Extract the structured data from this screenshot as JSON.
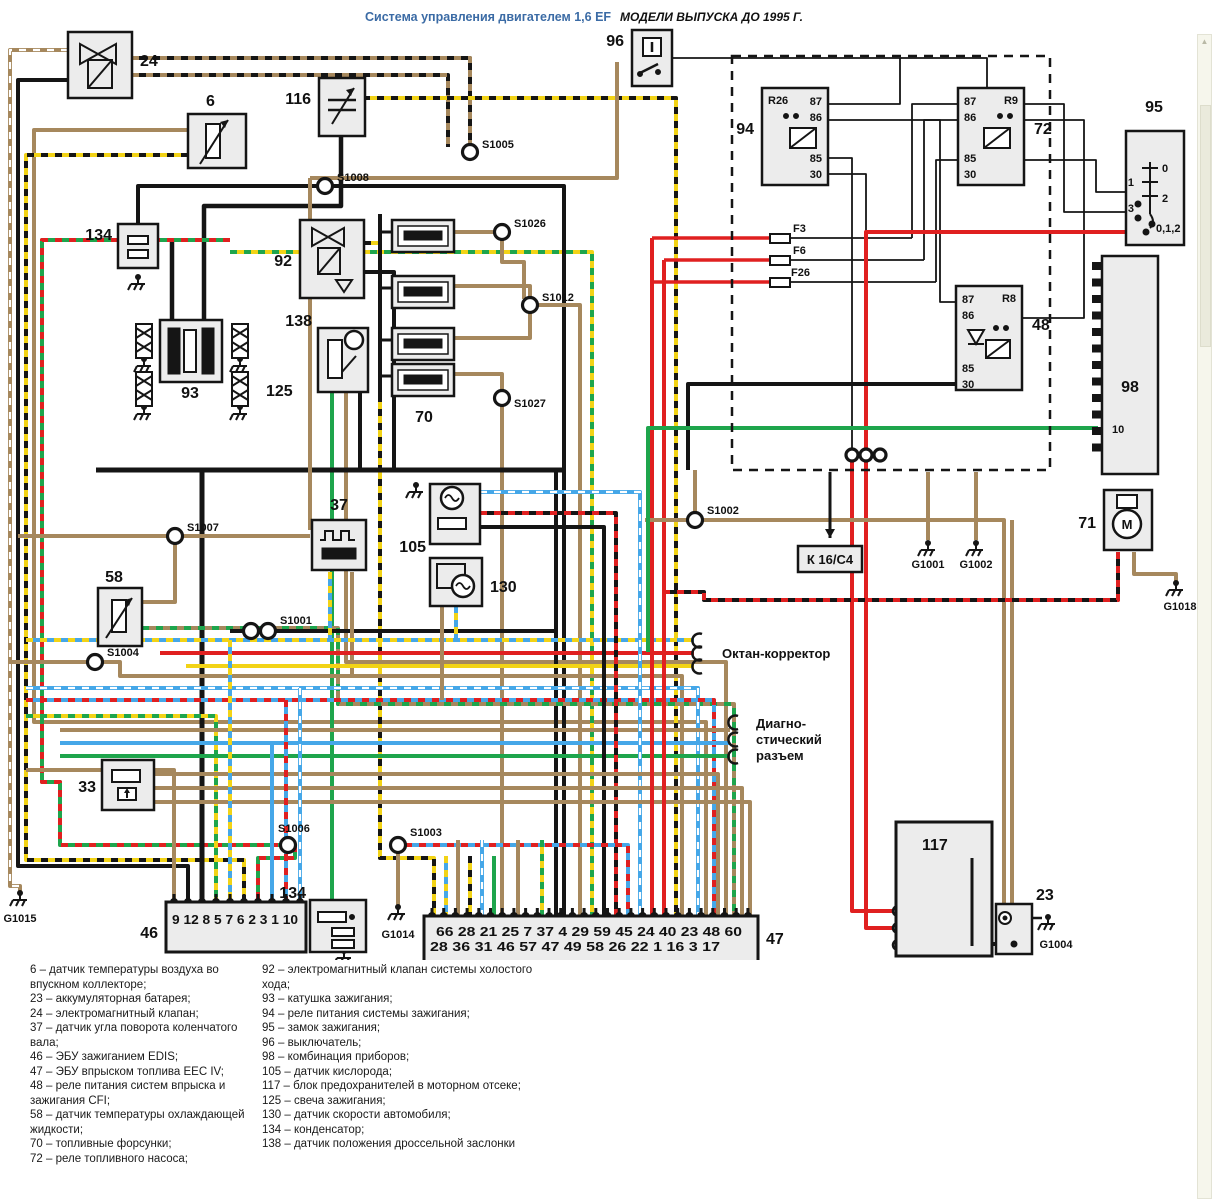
{
  "page": {
    "title": "Система управления двигателем 1,6 EF",
    "subtitle": "МОДЕЛИ ВЫПУСКА ДО 1995 Г."
  },
  "colors": {
    "title_blue": "#3b6ba5",
    "black": "#151515",
    "brown": "#a6885d",
    "red": "#e02020",
    "green": "#1ea54c",
    "yellow": "#f2d316",
    "blue": "#45a7e8",
    "white": "#ffffff",
    "box_fill": "#ececec"
  },
  "comp": {
    "c6": "6",
    "c23": "23",
    "c24": "24",
    "c33": "33",
    "c37": "37",
    "c46": "46",
    "c47": "47",
    "c48": "48",
    "c58": "58",
    "c70": "70",
    "c71": "71",
    "c72": "72",
    "c92": "92",
    "c93": "93",
    "c94": "94",
    "c95": "95",
    "c96": "96",
    "c98": "98",
    "c105": "105",
    "c116": "116",
    "c117": "117",
    "c125": "125",
    "c130": "130",
    "c134a": "134",
    "c134b": "134",
    "c138": "138"
  },
  "relays": {
    "tags": {
      "r94": "R26",
      "r72": "R9",
      "r48": "R8"
    },
    "pins": [
      "87",
      "86",
      "85",
      "30"
    ]
  },
  "lock": {
    "marks": [
      "0",
      "1",
      "2",
      "3"
    ],
    "combo": "0,1,2"
  },
  "fuses": {
    "f3": "F3",
    "f6": "F6",
    "f26": "F26"
  },
  "fusebox": {
    "letters": [
      "F",
      "E",
      "D",
      "C",
      "B",
      "A"
    ]
  },
  "cluster": {
    "pin10": "10"
  },
  "kbox": {
    "label": "К 16/С4"
  },
  "motor": {
    "m": "M"
  },
  "nodes": {
    "s1001": "S1001",
    "s1002": "S1002",
    "s1003": "S1003",
    "s1004": "S1004",
    "s1005": "S1005",
    "s1006": "S1006",
    "s1007": "S1007",
    "s1008": "S1008",
    "s1012": "S1012",
    "s1026": "S1026",
    "s1027": "S1027"
  },
  "grounds": {
    "g1001": "G1001",
    "g1002": "G1002",
    "g1004": "G1004",
    "g1014": "G1014",
    "g1015": "G1015",
    "g1018": "G1018"
  },
  "misc": {
    "octane": "Октан-корректор",
    "diag1": "Диагно-",
    "diag2": "стический",
    "diag3": "разъем"
  },
  "conn46": {
    "pins": "9 12 8 5 7 6 2 3 1 10"
  },
  "conn47": {
    "row1": "66  28  21  25  7  37  4  29  59  45  24  40  23  48  60",
    "row2": "28  36    31  46  57  47  49  58  26  22  1  16  3  17"
  },
  "legend": {
    "left": [
      "6 – датчик температуры воздуха во впускном коллекторе;",
      "23 – аккумуляторная батарея;",
      "24 – электромагнитный клапан;",
      "37 – датчик угла поворота коленчатого вала;",
      "46 – ЭБУ зажиганием EDIS;",
      "47 – ЭБУ впрыском топлива EEC IV;",
      "48 – реле питания систем впрыска и зажигания CFI;",
      "58 – датчик температуры охлаждающей жидкости;",
      "70 – топливные форсунки;",
      "72 – реле топливного насоса;"
    ],
    "right": [
      "92 – электромагнитный клапан системы холостого хода;",
      "93 – катушка зажигания;",
      "94 – реле питания системы зажигания;",
      "95 – замок зажигания;",
      "96 – выключатель;",
      "98 – комбинация приборов;",
      "105 – датчик кислорода;",
      "117 – блок предохранителей в моторном отсеке;",
      "125 – свеча зажигания;",
      "130 – датчик скорости автомобиля;",
      "134 – конденсатор;",
      "138 – датчик положения дроссельной заслонки"
    ]
  }
}
